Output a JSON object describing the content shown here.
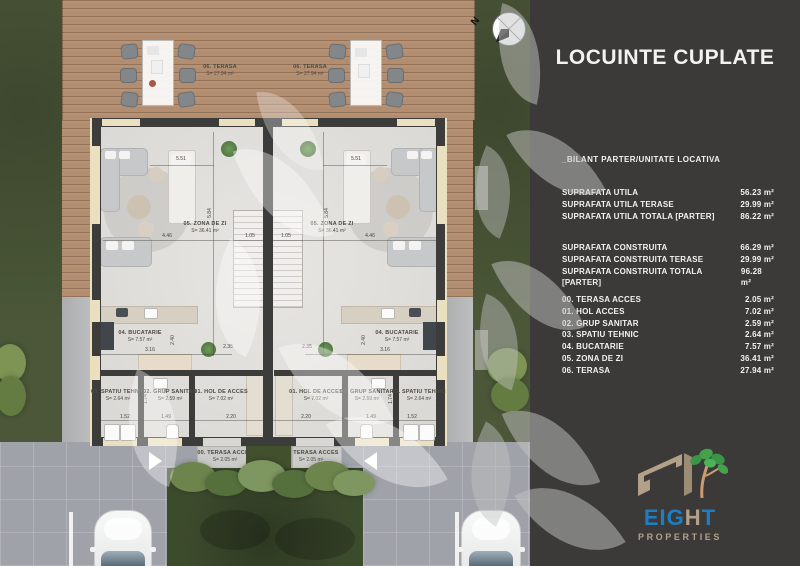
{
  "panel": {
    "title": "LOCUINTE CUPLATE",
    "subtitle": "_BILANT PARTER/UNITATE LOCATIVA",
    "groups": [
      {
        "rows": [
          {
            "label": "SUPRAFATA UTILA",
            "value": "56.23 m²"
          },
          {
            "label": "SUPRAFATA UTILA TERASE",
            "value": "29.99 m²"
          },
          {
            "label": "SUPRAFATA UTILA TOTALA [PARTER]",
            "value": "86.22 m²"
          }
        ]
      },
      {
        "rows": [
          {
            "label": "SUPRAFATA CONSTRUITA",
            "value": "66.29 m²"
          },
          {
            "label": "SUPRAFATA CONSTRUITA TERASE",
            "value": "29.99 m²"
          },
          {
            "label": "SUPRAFATA CONSTRUITA TOTALA [PARTER]",
            "value": "96.28 m²"
          }
        ]
      },
      {
        "rows": [
          {
            "label": "00. TERASA ACCES",
            "value": "2.05 m²"
          },
          {
            "label": "01. HOL ACCES",
            "value": "7.02 m²"
          },
          {
            "label": "02. GRUP SANITAR",
            "value": "2.59 m²"
          },
          {
            "label": "03. SPATIU TEHNIC",
            "value": "2.64 m²"
          },
          {
            "label": "04. BUCATARIE",
            "value": "7.57 m²"
          },
          {
            "label": "05. ZONA DE ZI",
            "value": "36.41 m²"
          },
          {
            "label": "06. TERASA",
            "value": "27.94 m²"
          }
        ]
      }
    ],
    "logo": {
      "eig": "EIG",
      "h": "H",
      "t": "T",
      "properties": "PROPERTIES"
    }
  },
  "plan": {
    "compass_n": "N",
    "rooms": {
      "terasa": {
        "name": "06. TERASA",
        "area": "S= 27.94 m²"
      },
      "zona": {
        "name": "05. ZONA DE ZI",
        "area": "S= 36.41 m²"
      },
      "bucatarie": {
        "name": "04. BUCATARIE",
        "area": "S= 7.57 m²"
      },
      "spatiu": {
        "name": "03. SPATIU TEHNIC",
        "area": "S= 2.64 m²"
      },
      "grup": {
        "name": "02. GRUP SANITAR",
        "area": "S= 2.59 m²"
      },
      "hol": {
        "name": "01. HOL DE ACCES",
        "area": "S= 7.02 m²"
      },
      "terasa_acces": {
        "name": "00. TERASA ACCES",
        "area": "S= 2.05 m²"
      }
    },
    "dims": {
      "d551": "5.51",
      "d446": "4.46",
      "d584": "5.84",
      "d105": "1.05",
      "d235": "2.35",
      "d240": "2.40",
      "d316": "3.16",
      "d174": "1.74",
      "d152": "1.52",
      "d149": "1.49",
      "d220": "2.20"
    }
  },
  "colors": {
    "panel_bg": "#3b3a39",
    "accent_blue": "#1d7ec4",
    "logo_tan": "#b2a089",
    "tree_green": "#44a24d",
    "grass": "#4b5738",
    "wood": "#b28d70"
  }
}
